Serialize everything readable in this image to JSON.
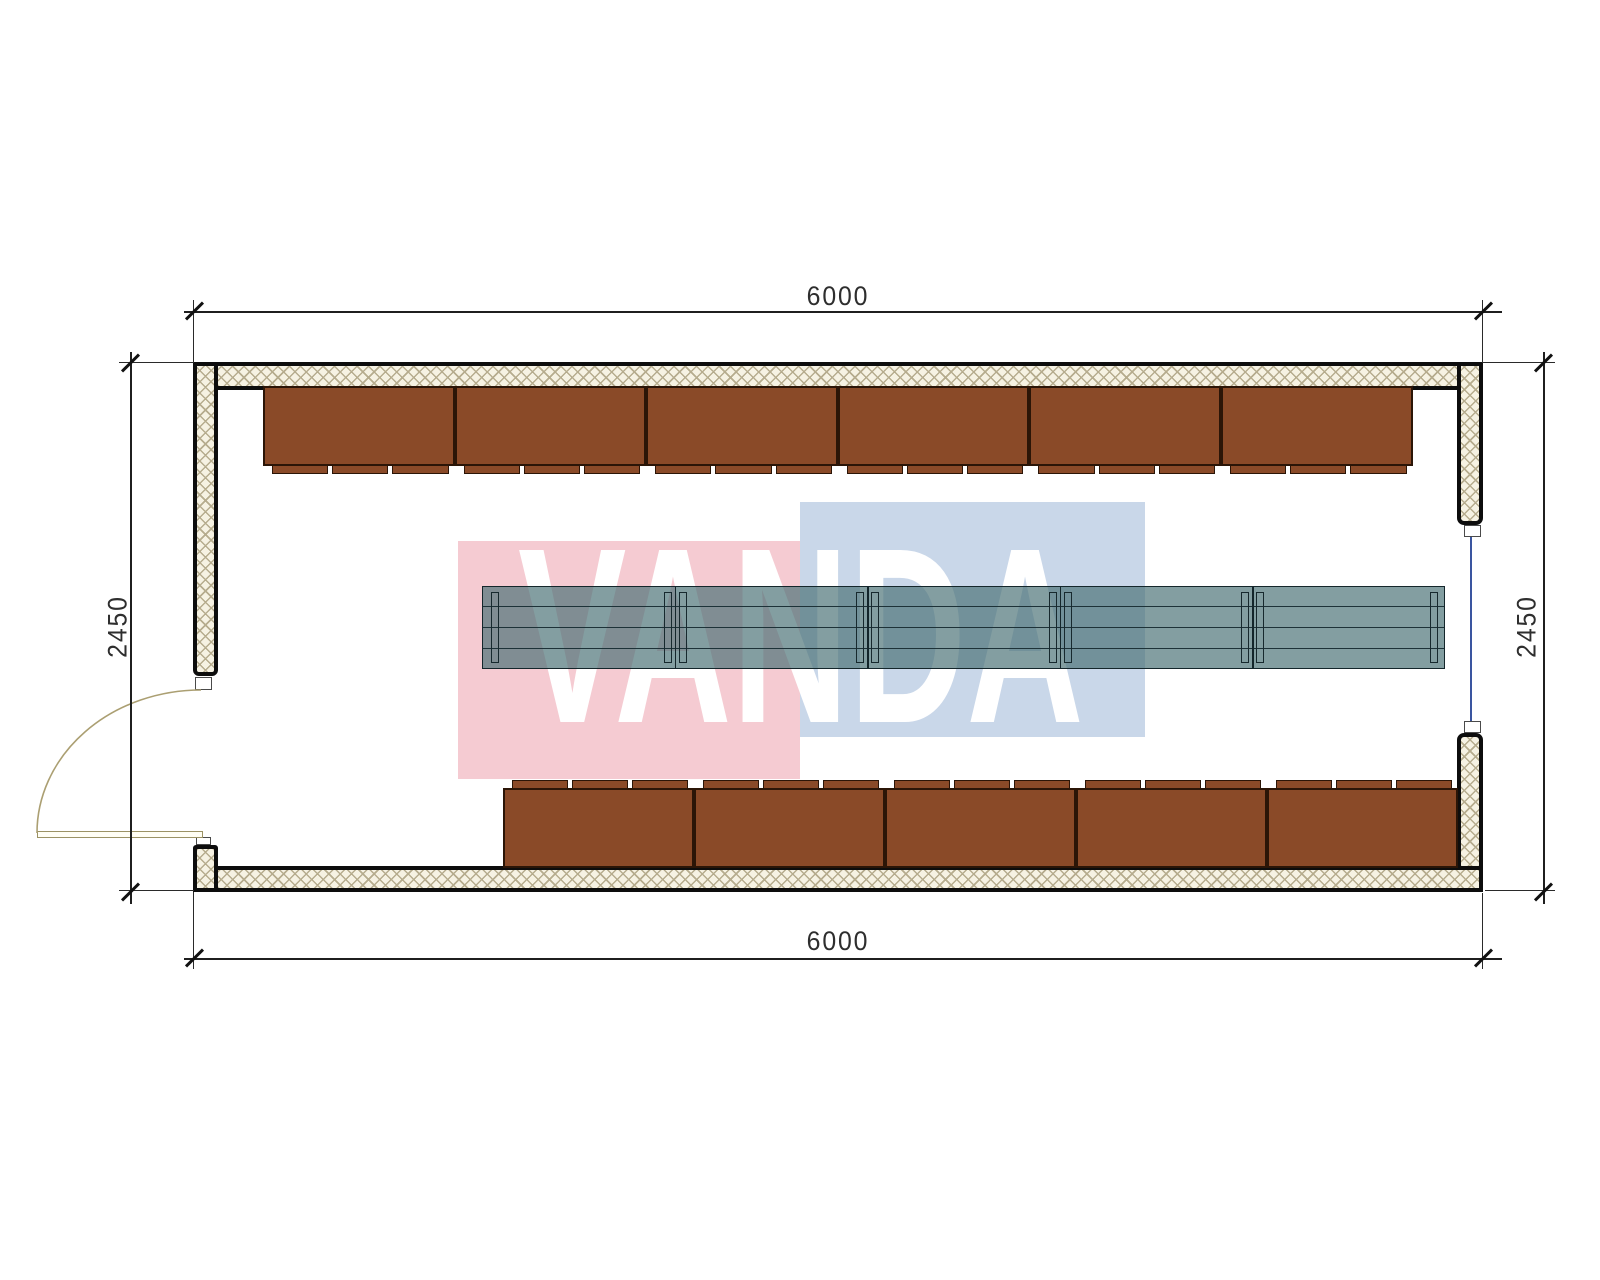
{
  "watermark": {
    "text": "VANDA",
    "pink_color": "#f5cbd2",
    "blue_color": "#c9d7e9",
    "text_color": "#ffffff"
  },
  "dimensions": {
    "top": "6000",
    "bottom": "6000",
    "left": "2450",
    "right": "2450"
  },
  "plan": {
    "benches": {
      "top_count": 6,
      "bottom_count": 5,
      "tabs_per_bench": 3,
      "fill": "#8a4a28",
      "border": "#2b1507"
    },
    "table": {
      "segments": 5,
      "fill": "rgba(72,112,117,0.68)"
    },
    "window": {
      "color": "#3a55a0"
    }
  }
}
